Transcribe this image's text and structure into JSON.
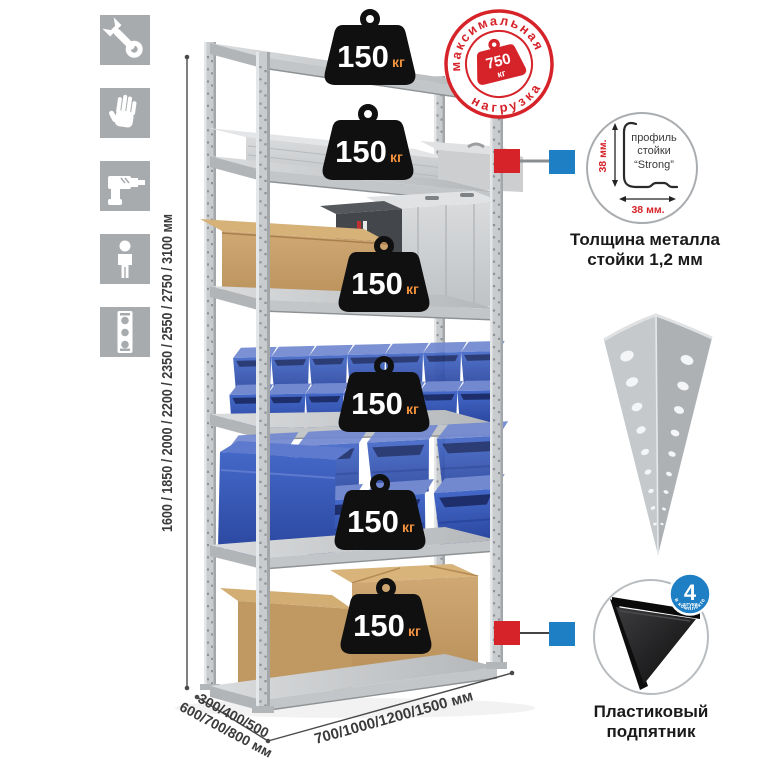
{
  "sidebar_icons": {
    "tile_color": "#a8abad",
    "items": [
      {
        "name": "wrench-icon"
      },
      {
        "name": "gloves-icon"
      },
      {
        "name": "drill-icon"
      },
      {
        "name": "person-icon"
      },
      {
        "name": "level-icon"
      }
    ]
  },
  "rack": {
    "weights": [
      {
        "value": "150",
        "unit": "кг"
      },
      {
        "value": "150",
        "unit": "кг"
      },
      {
        "value": "150",
        "unit": "кг"
      },
      {
        "value": "150",
        "unit": "кг"
      },
      {
        "value": "150",
        "unit": "кг"
      },
      {
        "value": "150",
        "unit": "кг"
      }
    ]
  },
  "stamp": {
    "arc_top": "максимальная",
    "arc_bottom": "нагрузка",
    "weight_value": "750",
    "weight_unit": "кг"
  },
  "profile_detail": {
    "label_line1": "профиль",
    "label_line2": "стойки",
    "label_line3": "“Strong”",
    "dim_vertical": "38 мм.",
    "dim_horizontal": "38 мм.",
    "caption_line1": "Толщина металла",
    "caption_line2": "стойки 1,2 мм"
  },
  "foot_detail": {
    "badge_value": "4",
    "badge_unit": "штуки",
    "badge_arc": "в комплекте",
    "caption_line1": "Пластиковый",
    "caption_line2": "подпятник"
  },
  "dimensions": {
    "height_label": "1600 / 1850 / 2000 / 2200 / 2350 / 2550 / 2750 / 3100 мм",
    "depth_label_line1": "300/400/500",
    "depth_label_line2": "600/700/800 мм",
    "width_label": "700/1000/1200/1500 мм"
  },
  "colors": {
    "accent_red": "#d6232a",
    "accent_blue": "#1f7fc4",
    "bin_blue": "#3b5fc4",
    "metal_gray": "#c9ccce",
    "cardboard": "#c59e66",
    "badge_black": "#101010",
    "kg_orange": "#f0923d"
  }
}
